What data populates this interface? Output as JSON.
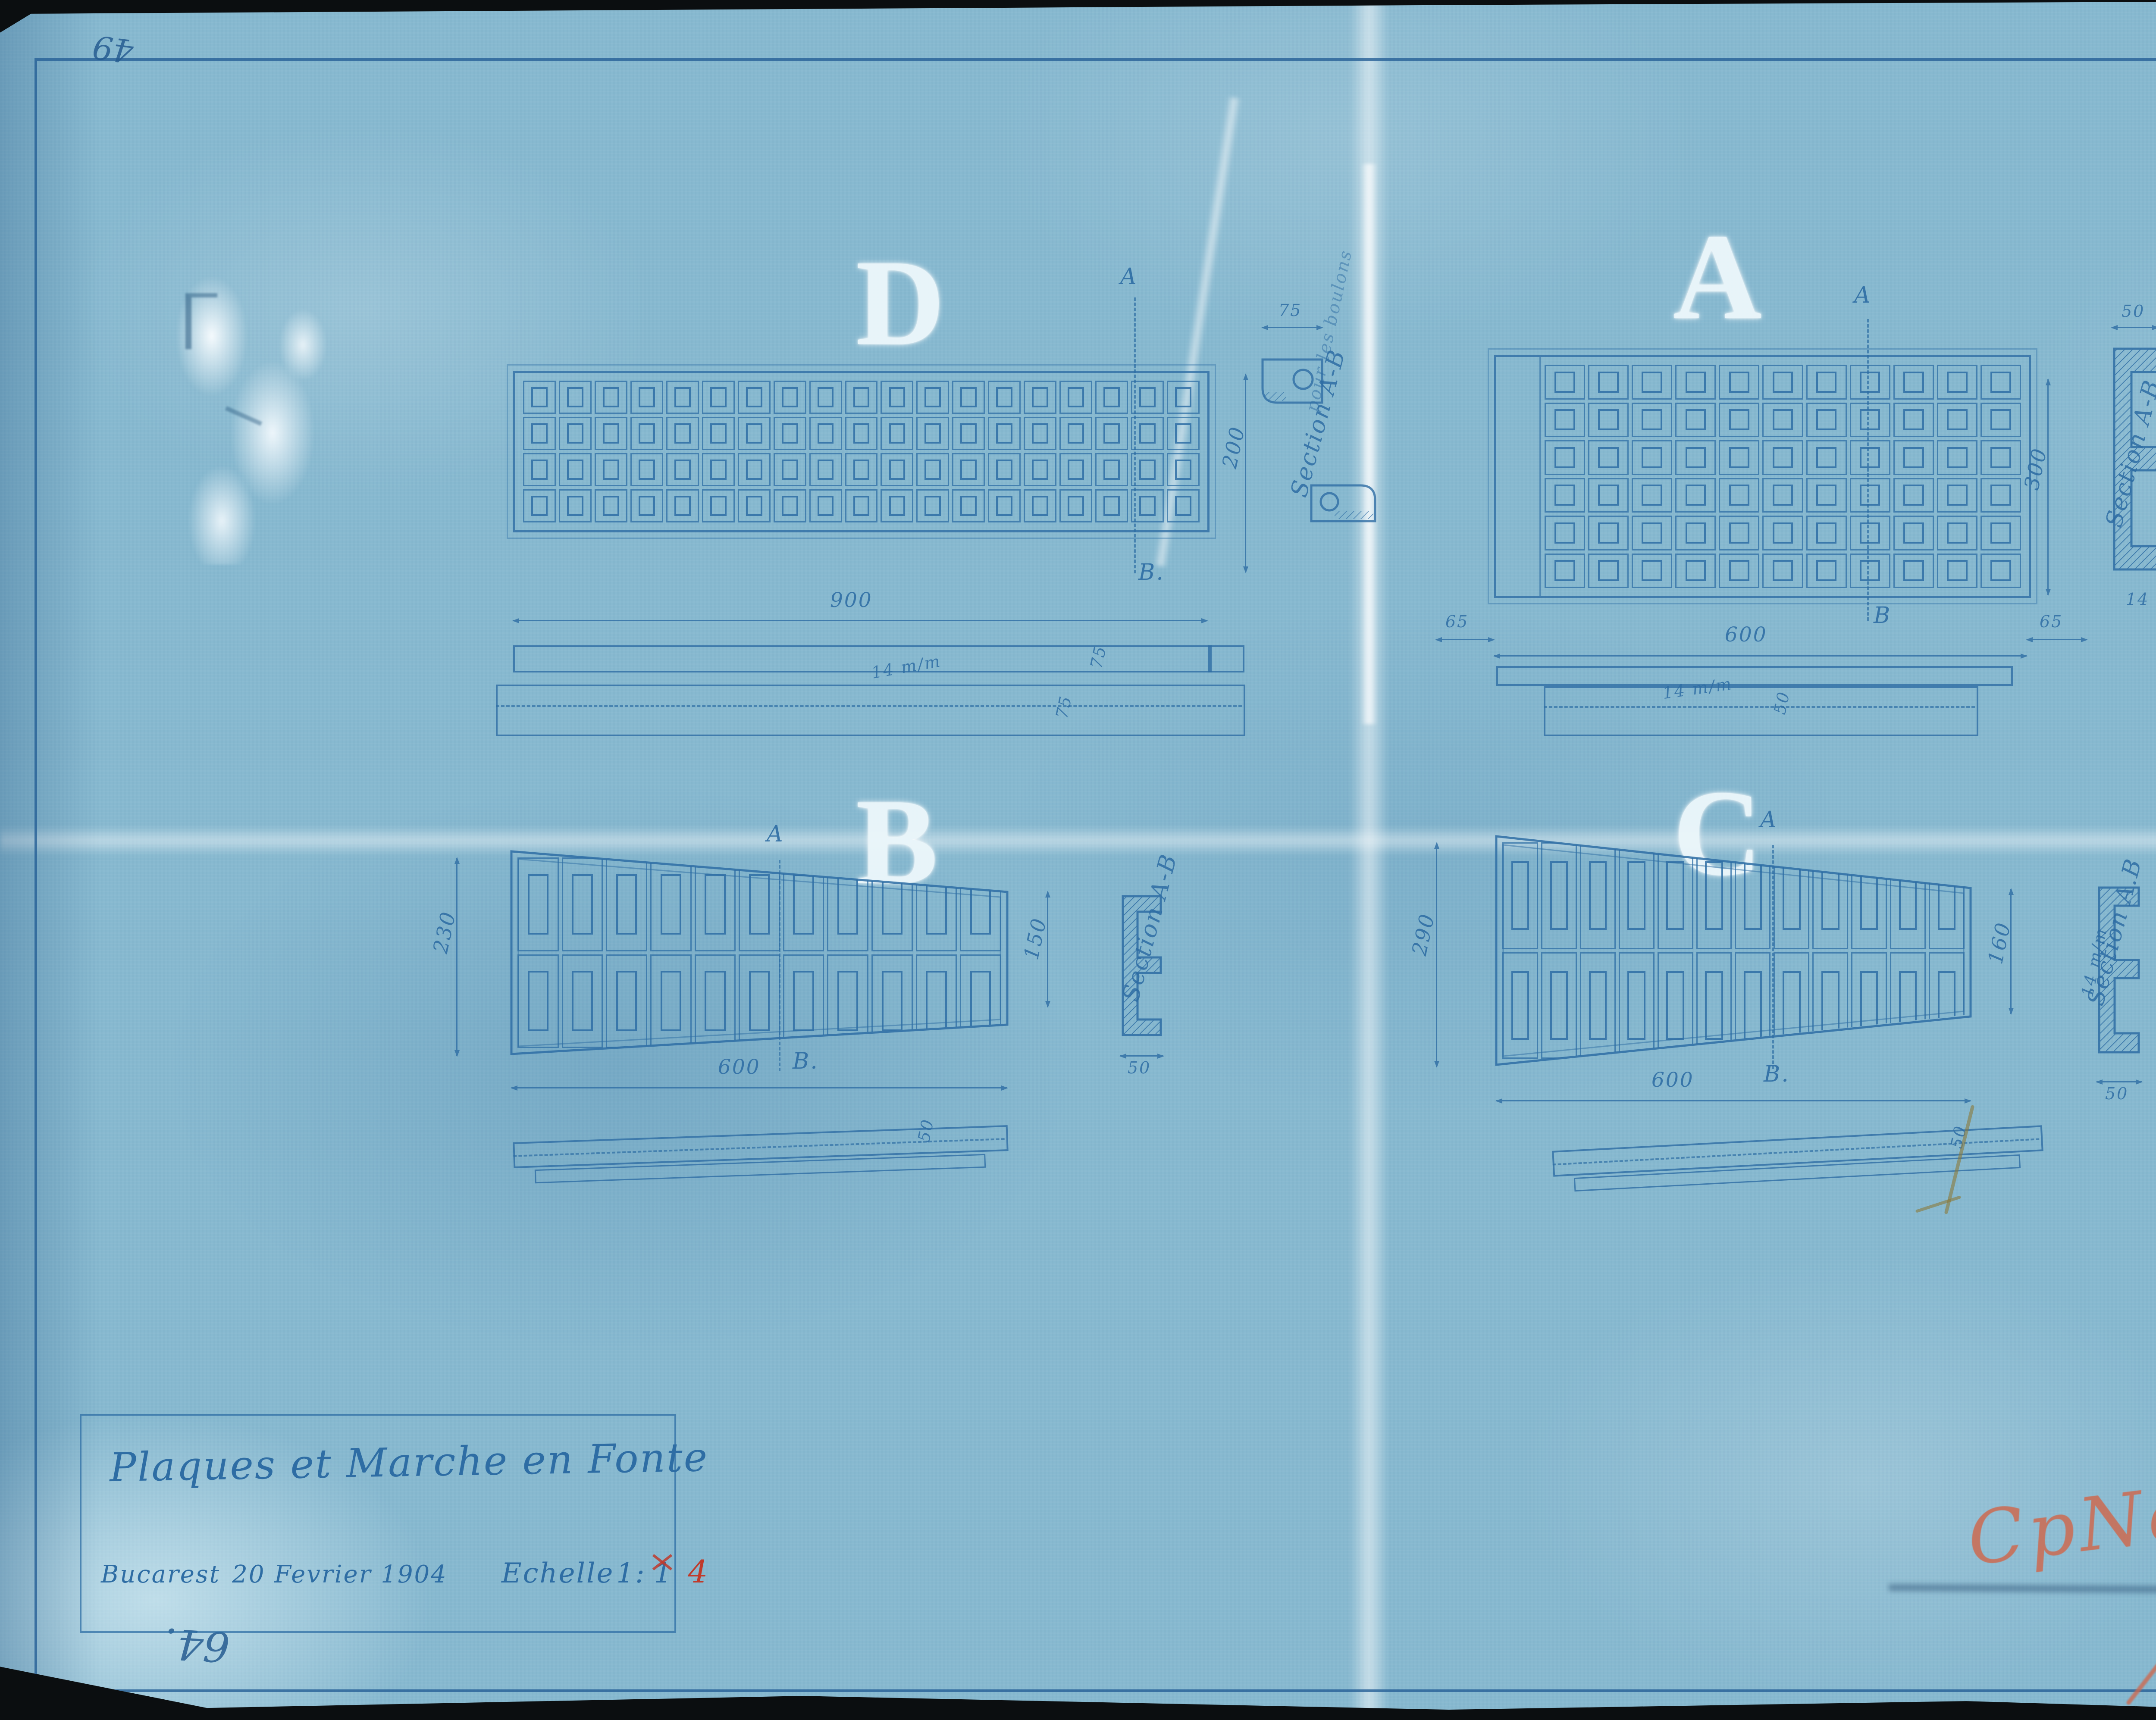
{
  "meta": {
    "corner_top_left": "49",
    "corner_bottom_left": "64.",
    "paper_color": "#87b9d0",
    "ink_color": "#2e6da4",
    "red_color": "#c03a2b",
    "crayon_color": "#cd6a50",
    "stamp_blue": "#33669f"
  },
  "stamps": {
    "top_right": "ROMÂNO-AMERICANA",
    "bottom_right_white": "ROMANO-AMERICANA",
    "circle": {
      "number": "2580",
      "letter": "S"
    },
    "red_inscription": "CpNo 4046 f",
    "red_fraction": "2",
    "blue_number": "64"
  },
  "title_block": {
    "title": "Plaques et Marche en Fonte",
    "place": "Bucarest",
    "date": "20 Fevrier 1904",
    "scale_word": "Echelle",
    "scale_prefix": "1:",
    "scale_old": "1",
    "scale_new": "4"
  },
  "drawings": {
    "D": {
      "letter": "D",
      "marker_top": "A",
      "marker_bottom": "B.",
      "length": "900",
      "height": "200",
      "section_label": "Section A-B",
      "detail_width": "75",
      "thickness_top": "75",
      "thickness_bottom": "75",
      "slope_note": "14 m/m",
      "note": "pour les boulons",
      "grid": {
        "rows": 4,
        "cols": 19
      }
    },
    "A": {
      "letter": "A",
      "marker_top": "A",
      "marker_bottom": "B",
      "length": "600",
      "margin_left": "65",
      "margin_right": "65",
      "height": "300",
      "section_label": "Section A-B",
      "profile_width": "50",
      "flange_top": "12 m/m",
      "rib": "12 m/m",
      "flange_bottom": "12 m/m",
      "base_width": "14 m/m",
      "step_dim": "50",
      "slope_note": "14 m/m",
      "grid": {
        "rows": 6,
        "cols": 11
      }
    },
    "B": {
      "letter": "B",
      "marker_top": "A",
      "marker_bottom": "B.",
      "height_left": "230",
      "height_right": "150",
      "length": "600",
      "section_label": "Section A-B",
      "profile_width": "50",
      "side_dim": "50",
      "grid": {
        "rows": 2,
        "cols": 11
      }
    },
    "C": {
      "letter": "C",
      "marker_top": "A",
      "marker_bottom": "B.",
      "height_left": "290",
      "height_right": "160",
      "length": "600",
      "section_label": "Section A.B",
      "rib_note": "12 m/m",
      "flange_note": "12 m/m",
      "web_note": "14 m/m",
      "profile_width": "50",
      "side_dim": "50",
      "grid": {
        "rows": 2,
        "cols": 12
      }
    }
  }
}
